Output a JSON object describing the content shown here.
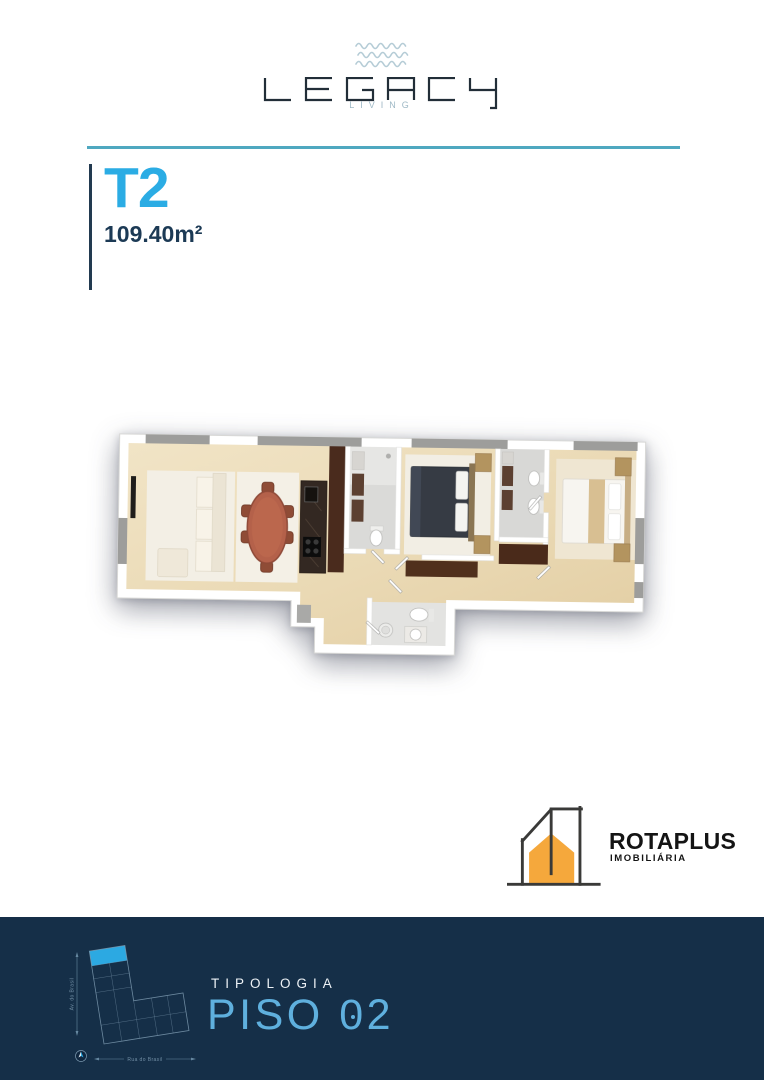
{
  "brand": {
    "wordmark": "LEGACY",
    "tagline": "LIVING",
    "wordmark_color": "#222E38",
    "tagline_color": "#9FB9C6",
    "waves_color": "#B5CCD6"
  },
  "unit": {
    "type_label": "T2",
    "area_label": "109.40m²",
    "type_color": "#2BACE4",
    "area_color": "#1C3A55"
  },
  "divider": {
    "color": "#4FA8C0"
  },
  "floorplan": {
    "description": "3D top-down render of T2 apartment floor plan"
  },
  "agency": {
    "name": "ROTAPLUS",
    "descriptor": "IMOBILIÁRIA",
    "house_color": "#F5A83C",
    "outline_color": "#3A3A38"
  },
  "footer": {
    "background": "#152F48",
    "eyebrow": "TIPOLOGIA",
    "floor_label": "PISO 02",
    "floor_parts": {
      "word": "PISO ",
      "zero": "0",
      "rest": "2"
    },
    "floor_color": "#5FB0DE",
    "map": {
      "highlight_color": "#2CA9E2",
      "line_color": "#7D9AB0",
      "street_left": "Av. do Brasil",
      "street_bottom": "Rua do Brasil"
    }
  }
}
